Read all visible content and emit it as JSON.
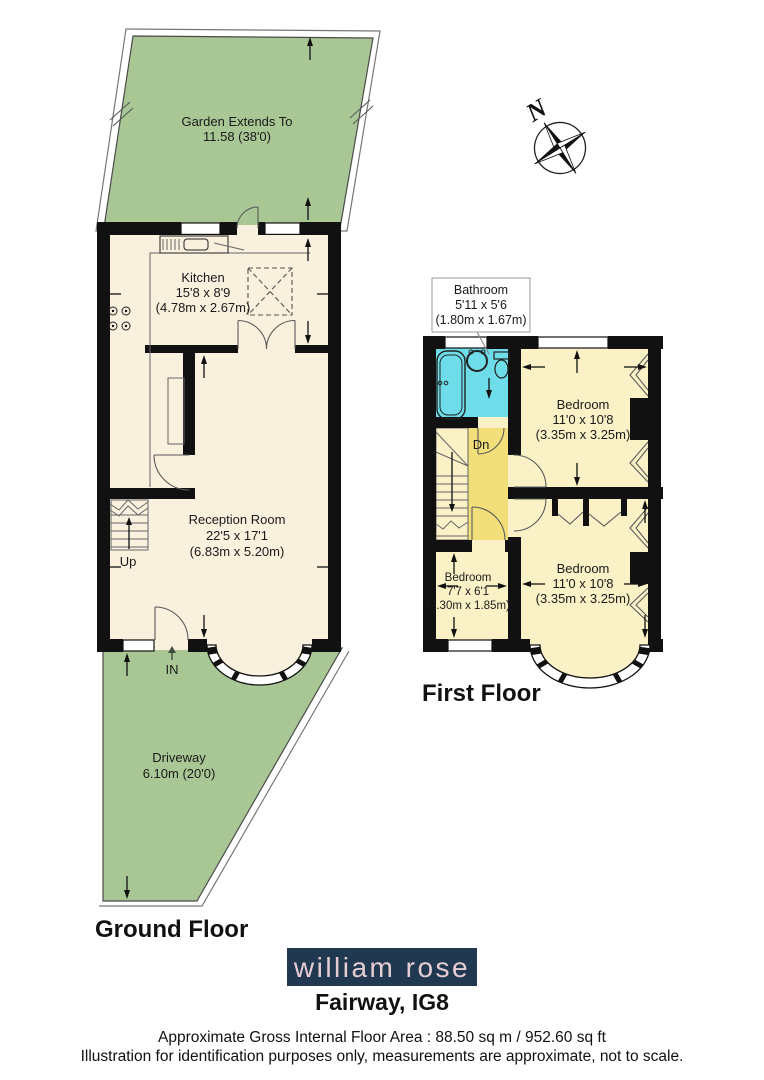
{
  "compass": {
    "north_label": "N"
  },
  "ground_floor": {
    "title": "Ground Floor",
    "garden": {
      "label_line1": "Garden Extends To",
      "label_line2": "11.58 (38'0)"
    },
    "kitchen": {
      "name": "Kitchen",
      "size_imperial": "15'8 x 8'9",
      "size_metric": "(4.78m x 2.67m)"
    },
    "reception_room": {
      "name": "Reception Room",
      "size_imperial": "22'5 x 17'1",
      "size_metric": "(6.83m x 5.20m)"
    },
    "driveway": {
      "name": "Driveway",
      "size": "6.10m (20'0)"
    },
    "stairs_label": "Up",
    "entrance_label": "IN"
  },
  "first_floor": {
    "title": "First Floor",
    "bathroom": {
      "name": "Bathroom",
      "size_imperial": "5'11 x 5'6",
      "size_metric": "(1.80m x 1.67m)"
    },
    "bedroom_front": {
      "name": "Bedroom",
      "size_imperial": "11'0 x 10'8",
      "size_metric": "(3.35m x 3.25m)"
    },
    "bedroom_back": {
      "name": "Bedroom",
      "size_imperial": "11'0 x 10'8",
      "size_metric": "(3.35m x 3.25m)"
    },
    "bedroom_small": {
      "name": "Bedroom",
      "size_imperial": "7'7 x 6'1",
      "size_metric": "(2.30m x 1.85m)"
    },
    "stairs_label": "Dn"
  },
  "footer": {
    "brand": "william rose",
    "address": "Fairway, IG8",
    "area_line": "Approximate Gross Internal Floor Area : 88.50 sq m / 952.60 sq ft",
    "disclaimer": "Illustration for identification purposes only, measurements are approximate, not to scale."
  },
  "colors": {
    "garden_green": "#a9c795",
    "floor_cream": "#faf0de",
    "bedroom_yellow": "#faf2c6",
    "landing_yellow": "#f2df7a",
    "bathroom_cyan": "#6edce9",
    "wall_black": "#111111",
    "logo_background": "#203950",
    "logo_text": "#e6cdd4"
  }
}
